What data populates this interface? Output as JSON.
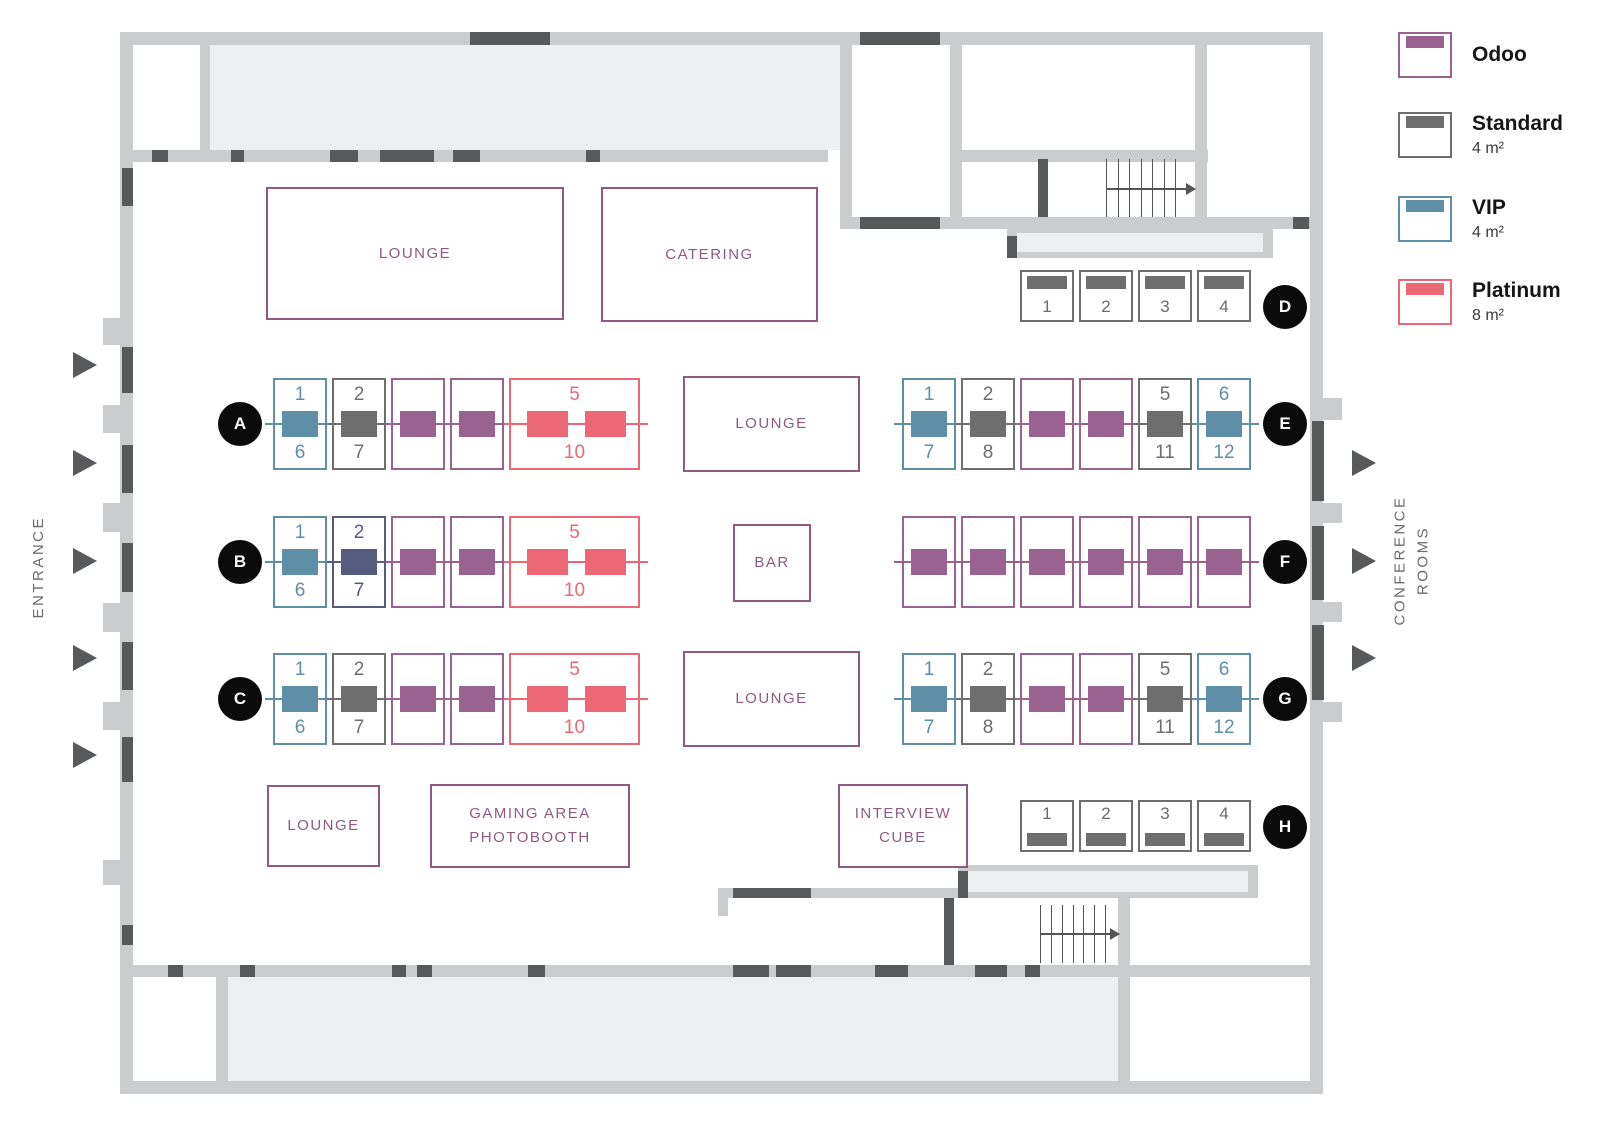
{
  "colors": {
    "odoo": "#9a6290",
    "standard": "#6e6e6e",
    "vip": "#5e8fa6",
    "platinum": "#ed6876",
    "indigo": "#575b7e"
  },
  "legend": {
    "items": [
      {
        "type": "odoo",
        "name": "Odoo",
        "size": ""
      },
      {
        "type": "standard",
        "name": "Standard",
        "size": "4 m²"
      },
      {
        "type": "vip",
        "name": "VIP",
        "size": "4 m²"
      },
      {
        "type": "platinum",
        "name": "Platinum",
        "size": "8 m²"
      }
    ]
  },
  "labels": {
    "entrance": "ENTRANCE",
    "conference_rooms": "CONFERENCE\nROOMS"
  },
  "rooms": [
    {
      "id": "lounge-top",
      "label": "LOUNGE"
    },
    {
      "id": "catering",
      "label": "CATERING"
    },
    {
      "id": "lounge-mid-upper",
      "label": "LOUNGE"
    },
    {
      "id": "bar",
      "label": "BAR"
    },
    {
      "id": "lounge-mid-lower",
      "label": "LOUNGE"
    },
    {
      "id": "lounge-bottom",
      "label": "LOUNGE"
    },
    {
      "id": "gaming",
      "label": "GAMING AREA\nPHOTOBOOTH"
    },
    {
      "id": "interview",
      "label": "INTERVIEW\nCUBE"
    }
  ],
  "booth_rows": [
    {
      "id": "A",
      "label": "A",
      "booths": [
        {
          "type": "vip",
          "top": "1",
          "bottom": "6"
        },
        {
          "type": "standard",
          "top": "2",
          "bottom": "7"
        },
        {
          "type": "odoo"
        },
        {
          "type": "odoo"
        },
        {
          "type": "platinum",
          "top": "5",
          "bottom": "10",
          "wide": true
        }
      ]
    },
    {
      "id": "B",
      "label": "B",
      "booths": [
        {
          "type": "vip",
          "top": "1",
          "bottom": "6"
        },
        {
          "type": "indigo",
          "top": "2",
          "bottom": "7"
        },
        {
          "type": "odoo"
        },
        {
          "type": "odoo"
        },
        {
          "type": "platinum",
          "top": "5",
          "bottom": "10",
          "wide": true
        }
      ]
    },
    {
      "id": "C",
      "label": "C",
      "booths": [
        {
          "type": "vip",
          "top": "1",
          "bottom": "6"
        },
        {
          "type": "standard",
          "top": "2",
          "bottom": "7"
        },
        {
          "type": "odoo"
        },
        {
          "type": "odoo"
        },
        {
          "type": "platinum",
          "top": "5",
          "bottom": "10",
          "wide": true
        }
      ]
    },
    {
      "id": "D",
      "label": "D",
      "style": "small",
      "bar": "top",
      "booths": [
        {
          "type": "standard",
          "num": "1"
        },
        {
          "type": "standard",
          "num": "2"
        },
        {
          "type": "standard",
          "num": "3"
        },
        {
          "type": "standard",
          "num": "4"
        }
      ]
    },
    {
      "id": "E",
      "label": "E",
      "booths": [
        {
          "type": "vip",
          "top": "1",
          "bottom": "7"
        },
        {
          "type": "standard",
          "top": "2",
          "bottom": "8"
        },
        {
          "type": "odoo"
        },
        {
          "type": "odoo"
        },
        {
          "type": "standard",
          "top": "5",
          "bottom": "11"
        },
        {
          "type": "vip",
          "top": "6",
          "bottom": "12"
        }
      ]
    },
    {
      "id": "F",
      "label": "F",
      "booths": [
        {
          "type": "odoo"
        },
        {
          "type": "odoo"
        },
        {
          "type": "odoo"
        },
        {
          "type": "odoo"
        },
        {
          "type": "odoo"
        },
        {
          "type": "odoo"
        }
      ]
    },
    {
      "id": "G",
      "label": "G",
      "booths": [
        {
          "type": "vip",
          "top": "1",
          "bottom": "7"
        },
        {
          "type": "standard",
          "top": "2",
          "bottom": "8"
        },
        {
          "type": "odoo"
        },
        {
          "type": "odoo"
        },
        {
          "type": "standard",
          "top": "5",
          "bottom": "11"
        },
        {
          "type": "vip",
          "top": "6",
          "bottom": "12"
        }
      ]
    },
    {
      "id": "H",
      "label": "H",
      "style": "small",
      "bar": "bottom",
      "booths": [
        {
          "type": "standard",
          "num": "1"
        },
        {
          "type": "standard",
          "num": "2"
        },
        {
          "type": "standard",
          "num": "3"
        },
        {
          "type": "standard",
          "num": "4"
        }
      ]
    }
  ]
}
